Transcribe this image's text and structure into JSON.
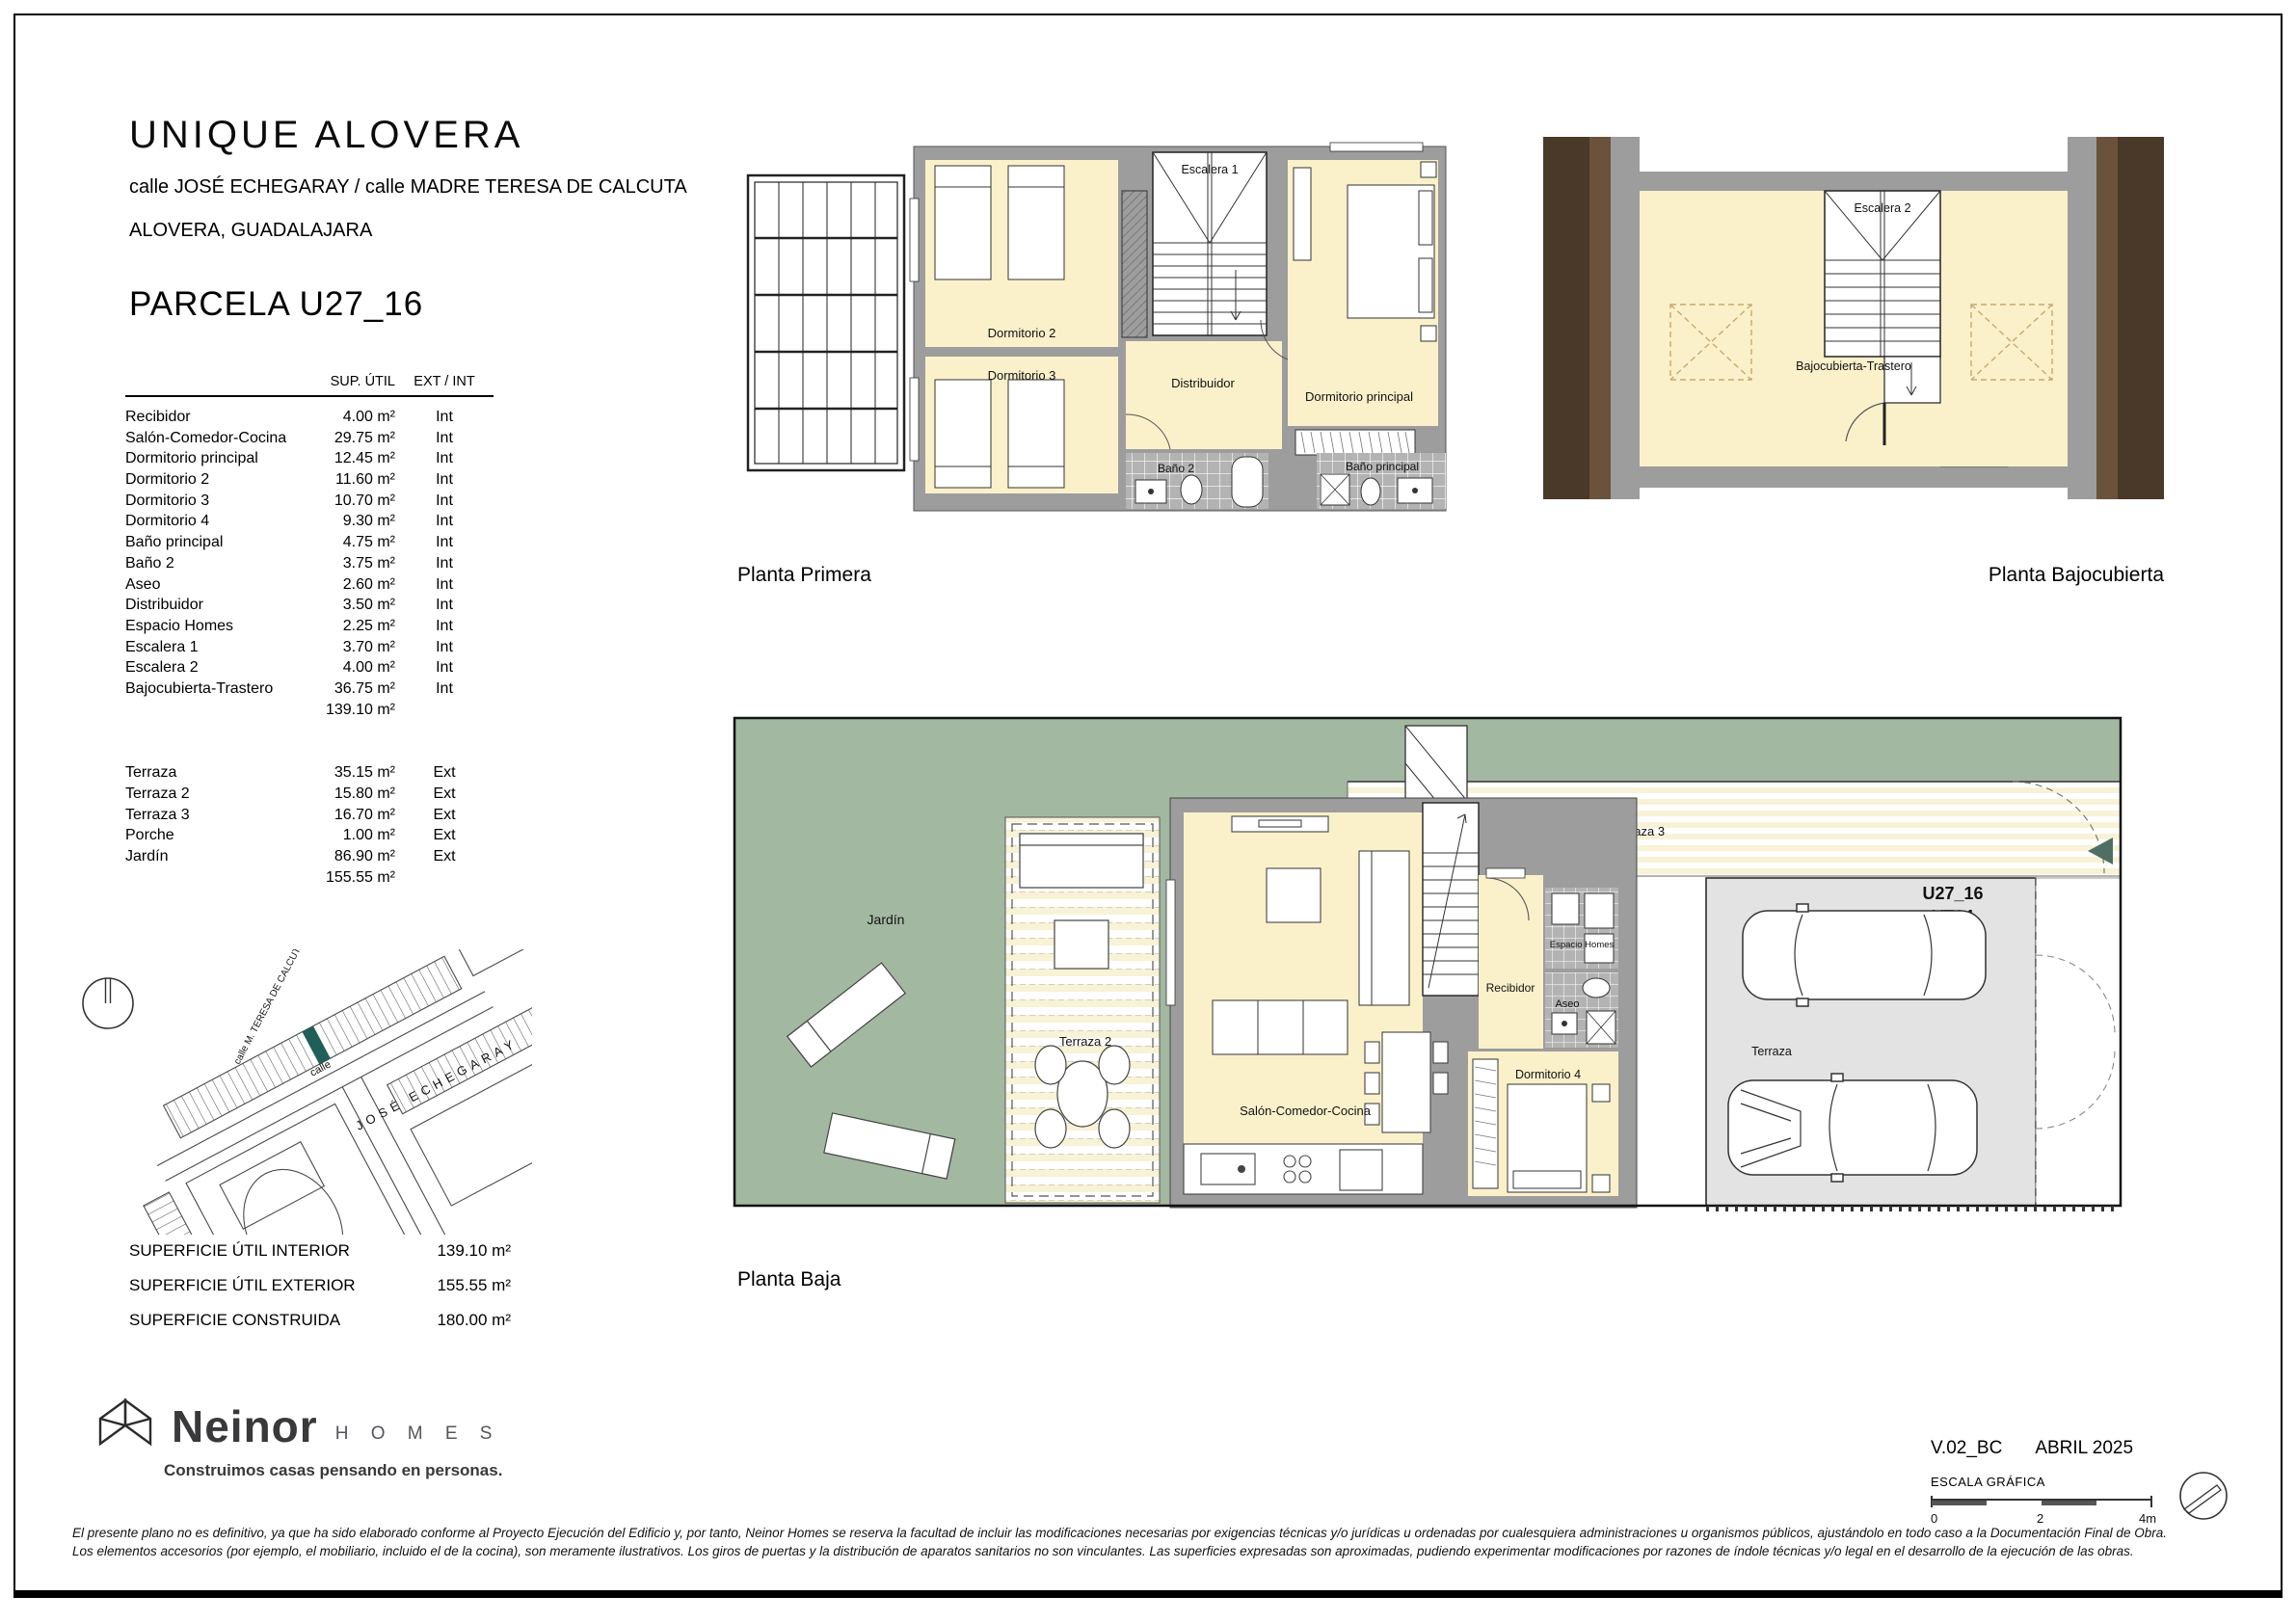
{
  "header": {
    "title": "UNIQUE  ALOVERA",
    "address_line1": "calle JOSÉ ECHEGARAY / calle MADRE TERESA DE CALCUTA",
    "address_line2": "ALOVERA, GUADALAJARA",
    "parcel": "PARCELA U27_16"
  },
  "area_table": {
    "col_area": "SUP. ÚTIL",
    "col_extint": "EXT / INT",
    "interior_rows": [
      {
        "label": "Recibidor",
        "area": "4.00 m²",
        "type": "Int"
      },
      {
        "label": "Salón-Comedor-Cocina",
        "area": "29.75 m²",
        "type": "Int"
      },
      {
        "label": "Dormitorio principal",
        "area": "12.45 m²",
        "type": "Int"
      },
      {
        "label": "Dormitorio 2",
        "area": "11.60 m²",
        "type": "Int"
      },
      {
        "label": "Dormitorio 3",
        "area": "10.70 m²",
        "type": "Int"
      },
      {
        "label": "Dormitorio 4",
        "area": "9.30 m²",
        "type": "Int"
      },
      {
        "label": "Baño principal",
        "area": "4.75 m²",
        "type": "Int"
      },
      {
        "label": "Baño 2",
        "area": "3.75 m²",
        "type": "Int"
      },
      {
        "label": "Aseo",
        "area": "2.60 m²",
        "type": "Int"
      },
      {
        "label": "Distribuidor",
        "area": "3.50 m²",
        "type": "Int"
      },
      {
        "label": "Espacio Homes",
        "area": "2.25 m²",
        "type": "Int"
      },
      {
        "label": "Escalera 1",
        "area": "3.70 m²",
        "type": "Int"
      },
      {
        "label": "Escalera 2",
        "area": "4.00 m²",
        "type": "Int"
      },
      {
        "label": "Bajocubierta-Trastero",
        "area": "36.75 m²",
        "type": "Int"
      }
    ],
    "interior_total": "139.10 m²",
    "exterior_rows": [
      {
        "label": "Terraza",
        "area": "35.15 m²",
        "type": "Ext"
      },
      {
        "label": "Terraza 2",
        "area": "15.80 m²",
        "type": "Ext"
      },
      {
        "label": "Terraza 3",
        "area": "16.70 m²",
        "type": "Ext"
      },
      {
        "label": "Porche",
        "area": "1.00 m²",
        "type": "Ext"
      },
      {
        "label": "Jardín",
        "area": "86.90 m²",
        "type": "Ext"
      }
    ],
    "exterior_total": "155.55 m²"
  },
  "totals": [
    {
      "label": "SUPERFICIE ÚTIL INTERIOR",
      "value": "139.10 m²"
    },
    {
      "label": "SUPERFICIE ÚTIL EXTERIOR",
      "value": "155.55 m²"
    },
    {
      "label": "SUPERFICIE CONSTRUIDA",
      "value": "180.00 m²"
    }
  ],
  "plans": {
    "primera": {
      "label": "Planta Primera",
      "rooms": {
        "dorm2": "Dormitorio 2",
        "dorm3": "Dormitorio 3",
        "escalera1": "Escalera 1",
        "distribuidor": "Distribuidor",
        "dorm_principal": "Dormitorio principal",
        "bano2": "Baño 2",
        "bano_principal": "Baño principal"
      }
    },
    "bajocubierta": {
      "label": "Planta Bajocubierta",
      "rooms": {
        "escalera2": "Escalera 2",
        "trastero": "Bajocubierta-Trastero"
      }
    },
    "baja": {
      "label": "Planta Baja",
      "rooms": {
        "jardin": "Jardín",
        "terraza2": "Terraza 2",
        "terraza3": "Terraza 3",
        "porche": "Porche",
        "salon": "Salón-Comedor-Cocina",
        "recibidor": "Recibidor",
        "espacio_homes": "Espacio Homes",
        "aseo": "Aseo",
        "dorm4": "Dormitorio 4",
        "terraza": "Terraza"
      },
      "unit_line1": "U27_16",
      "unit_line2": "VT04"
    }
  },
  "site_map": {
    "street_short": "calle",
    "street1": "JOSÉ  ECHEGARAY",
    "street2": "calle M. TERESA DE CALCUTA"
  },
  "brand": {
    "name": "Neinor",
    "sub": "H O M E S",
    "tagline": "Construimos casas pensando en personas."
  },
  "version": {
    "code": "V.02_BC",
    "date": "ABRIL 2025",
    "scale_label": "ESCALA GRÁFICA",
    "tick0": "0",
    "tick1": "2",
    "tick2": "4m"
  },
  "disclaimer": [
    "El presente plano no es definitivo, ya que ha sido elaborado conforme al Proyecto Ejecución del Edificio y, por tanto, Neinor Homes se reserva la facultad de incluir las modificaciones necesarias por exigencias técnicas y/o jurídicas u ordenadas por cualesquiera administraciones u organismos públicos, ajustándolo en todo caso a la Documentación Final de Obra.",
    "Los elementos accesorios (por ejemplo, el mobiliario, incluido el de la cocina), son meramente ilustrativos. Los giros de puertas y la distribución de aparatos sanitarios no son vinculantes. Las superficies expresadas son aproximadas, pudiendo experimentar modificaciones por razones de índole técnicas y/o legal en el desarrollo de la ejecución de las obras."
  ],
  "colors": {
    "room_cream": "#FAF1CB",
    "wall_gray": "#9D9D9D",
    "tile_gray": "#B3B3B3",
    "garden_green": "#A3B8A1",
    "garage_gray": "#E3E3E3",
    "roof_brown_dark": "#4A3828",
    "roof_brown_mid": "#6A523C",
    "plot_teal": "#1F5F58"
  }
}
